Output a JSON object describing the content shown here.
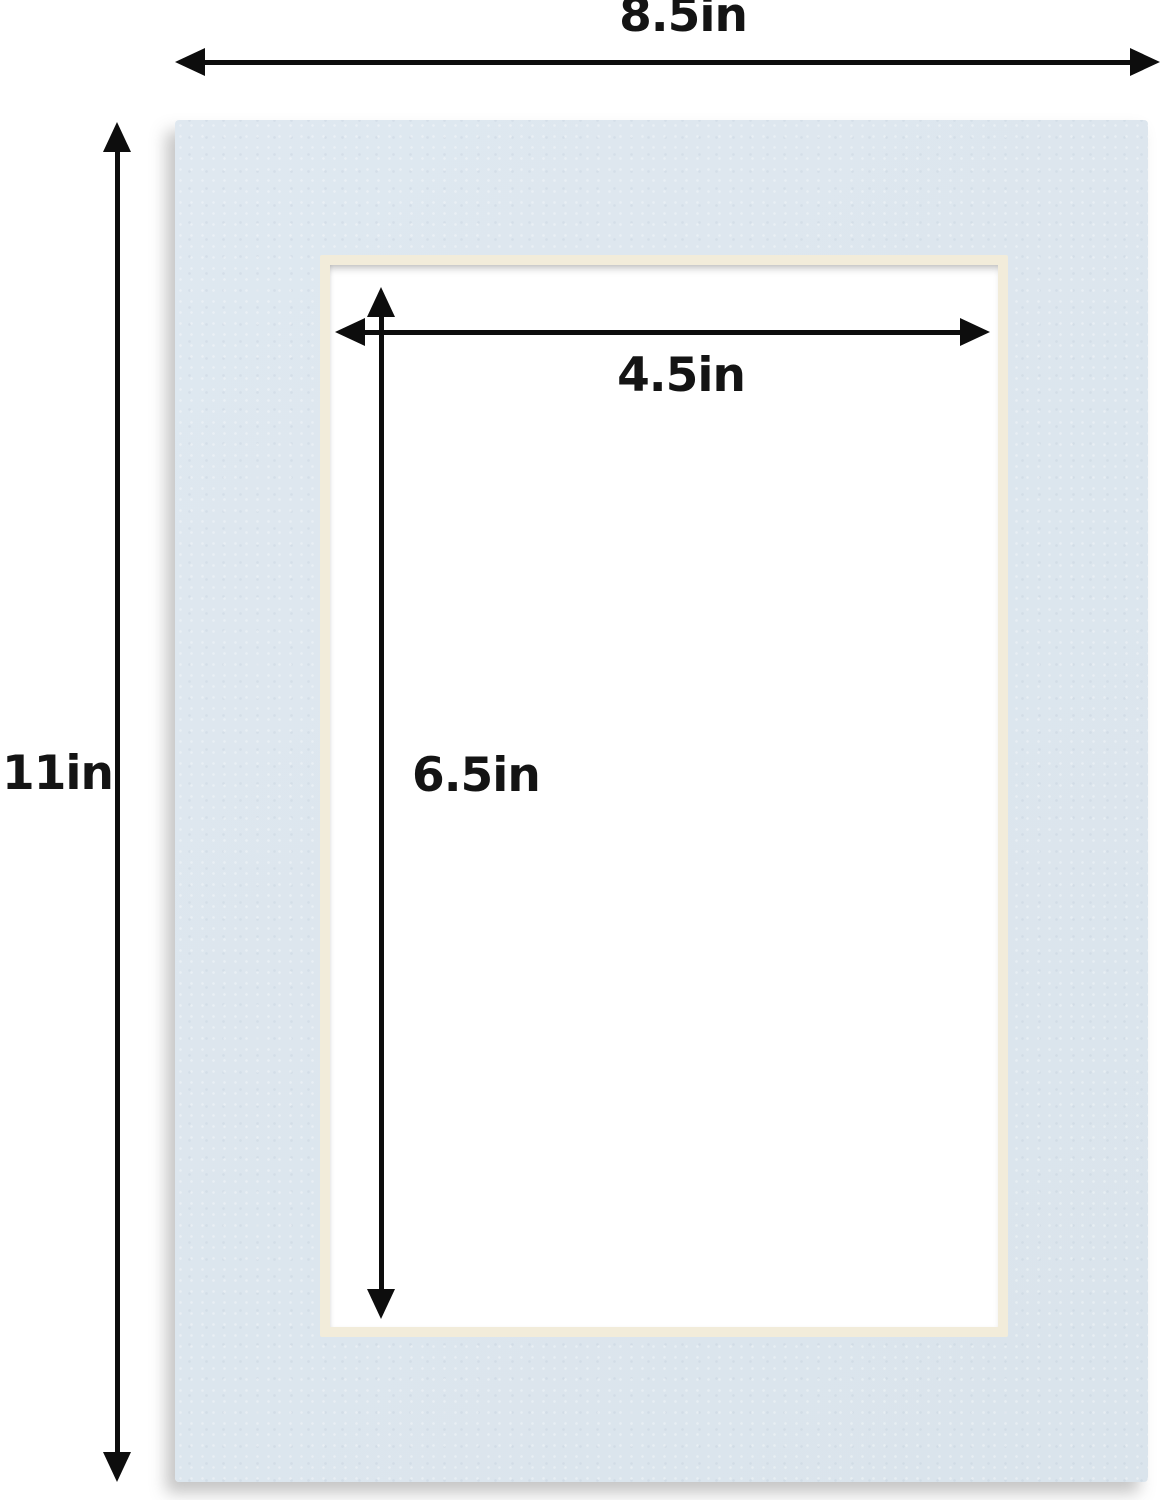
{
  "diagram": {
    "kind": "mat-board-dimension-diagram",
    "dimensions": {
      "outer_width": "8.5in",
      "outer_height": "11in",
      "opening_width": "4.5in",
      "opening_height": "6.5in"
    },
    "colors": {
      "background": "#ffffff",
      "mat": "#dce5ee",
      "bevel": "#f2ecda",
      "opening": "#ffffff",
      "arrow": "#0d0d0d",
      "label_text": "#141414"
    }
  }
}
